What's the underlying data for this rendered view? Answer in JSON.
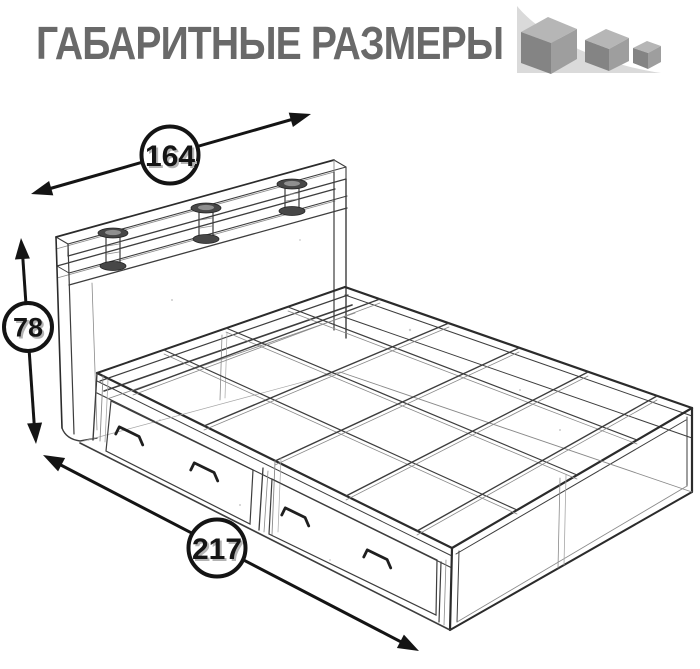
{
  "header": {
    "title": "ГАБАРИТНЫЕ РАЗМЕРЫ",
    "title_color": "#696969",
    "icon": "shrinking-cubes-icon"
  },
  "dimensions": {
    "width": "164",
    "height": "78",
    "length": "217"
  },
  "illustration": {
    "type": "wireframe-bed-drawing",
    "subject": "bed with headboard shelf and two underbed drawers",
    "line_color": "#3a3a3a"
  },
  "icon_colors": {
    "swoosh": "#dadada",
    "cube_top": "#b6b6b6",
    "cube_left": "#848484",
    "cube_right": "#9e9e9e"
  }
}
